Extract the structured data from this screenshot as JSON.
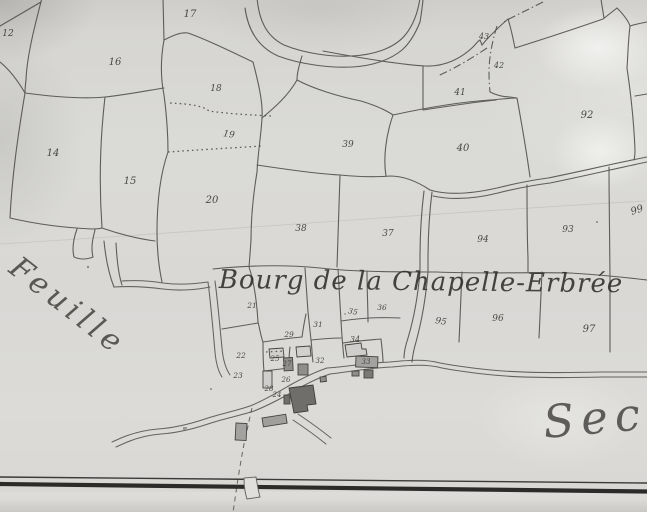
{
  "map": {
    "title_center": "Bourg de la Chapelle-Erbrée",
    "label_left": "Feuille",
    "label_bottom_right": "Sect",
    "parcel_numbers": [
      {
        "n": "12",
        "x": 8,
        "y": 33,
        "s": 9
      },
      {
        "n": "16",
        "x": 115,
        "y": 62,
        "s": 10
      },
      {
        "n": "17",
        "x": 190,
        "y": 14,
        "s": 10
      },
      {
        "n": "18",
        "x": 216,
        "y": 88,
        "s": 9
      },
      {
        "n": "19",
        "x": 229,
        "y": 134,
        "s": 9,
        "r": 8
      },
      {
        "n": "14",
        "x": 53,
        "y": 153,
        "s": 10
      },
      {
        "n": "15",
        "x": 130,
        "y": 181,
        "s": 10
      },
      {
        "n": "20",
        "x": 212,
        "y": 200,
        "s": 10
      },
      {
        "n": "38",
        "x": 301,
        "y": 228,
        "s": 9
      },
      {
        "n": "37",
        "x": 388,
        "y": 233,
        "s": 9
      },
      {
        "n": "39",
        "x": 348,
        "y": 144,
        "s": 9
      },
      {
        "n": "40",
        "x": 463,
        "y": 148,
        "s": 10
      },
      {
        "n": "41",
        "x": 460,
        "y": 92,
        "s": 9
      },
      {
        "n": "42",
        "x": 499,
        "y": 65,
        "s": 8
      },
      {
        "n": "43",
        "x": 484,
        "y": 36,
        "s": 8
      },
      {
        "n": "92",
        "x": 587,
        "y": 115,
        "s": 10
      },
      {
        "n": "99",
        "x": 637,
        "y": 210,
        "s": 10,
        "r": -18
      },
      {
        "n": "93",
        "x": 568,
        "y": 229,
        "s": 9
      },
      {
        "n": "94",
        "x": 483,
        "y": 239,
        "s": 9
      },
      {
        "n": "95",
        "x": 441,
        "y": 321,
        "s": 9,
        "r": 10
      },
      {
        "n": "96",
        "x": 498,
        "y": 318,
        "s": 9
      },
      {
        "n": "97",
        "x": 589,
        "y": 329,
        "s": 10
      },
      {
        "n": "21",
        "x": 252,
        "y": 305,
        "s": 7.5
      },
      {
        "n": "29",
        "x": 289,
        "y": 334,
        "s": 7.5
      },
      {
        "n": "31",
        "x": 318,
        "y": 324,
        "s": 7.5
      },
      {
        "n": "35",
        "x": 353,
        "y": 311,
        "s": 7.5,
        "r": 10
      },
      {
        "n": "36",
        "x": 382,
        "y": 307,
        "s": 7.5
      },
      {
        "n": "34",
        "x": 355,
        "y": 339,
        "s": 8
      },
      {
        "n": "22",
        "x": 241,
        "y": 355,
        "s": 7.5
      },
      {
        "n": "25",
        "x": 275,
        "y": 358,
        "s": 7
      },
      {
        "n": "27",
        "x": 287,
        "y": 363,
        "s": 7
      },
      {
        "n": "32",
        "x": 320,
        "y": 360,
        "s": 7
      },
      {
        "n": "33",
        "x": 366,
        "y": 361,
        "s": 7
      },
      {
        "n": "23",
        "x": 238,
        "y": 375,
        "s": 7.5
      },
      {
        "n": "26",
        "x": 286,
        "y": 379,
        "s": 7
      },
      {
        "n": "28",
        "x": 269,
        "y": 388,
        "s": 7
      },
      {
        "n": "24",
        "x": 277,
        "y": 394,
        "s": 7
      }
    ]
  },
  "colors": {
    "paper": "#d9d8d5",
    "ink": "#454441",
    "building_dark": "#6f6e6b",
    "building_light": "#a3a2a0",
    "border_line": "#2c2b29"
  }
}
